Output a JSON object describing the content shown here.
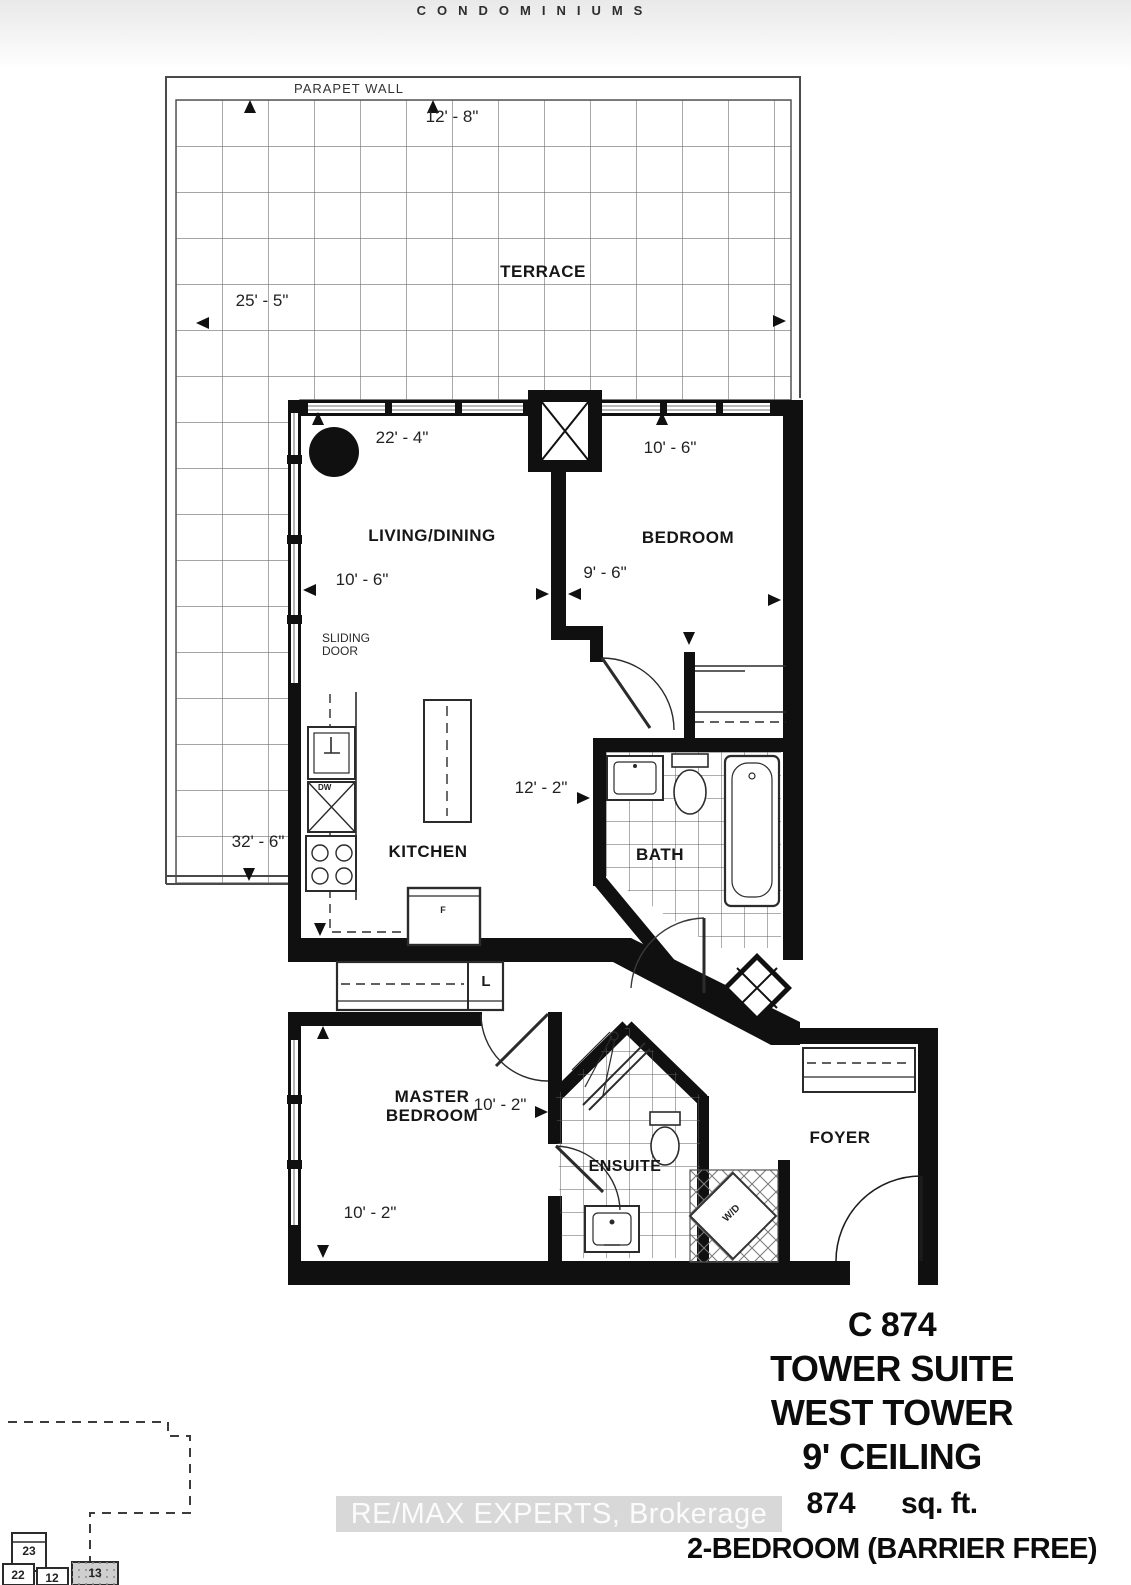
{
  "brand": "CONDOMINIUMS",
  "terrace": {
    "label": "TERRACE",
    "parapet": "PARAPET WALL",
    "dim_top": "12' - 8\"",
    "dim_left": "25' - 5\"",
    "dim_bottom": "32' - 6\""
  },
  "living": {
    "label": "LIVING/DINING",
    "dim_width": "22' - 4\"",
    "dim_depth": "10' - 6\"",
    "sliding_door": "SLIDING\nDOOR"
  },
  "bedroom": {
    "label": "BEDROOM",
    "dim_width": "10' - 6\"",
    "dim_depth": "9' - 6\""
  },
  "kitchen": {
    "label": "KITCHEN",
    "dim_hall": "12' - 2\"",
    "dishwasher": "DW",
    "fridge": "F",
    "linen": "L"
  },
  "bath": {
    "label": "BATH"
  },
  "master_bedroom": {
    "label": "MASTER\nBEDROOM",
    "dim_width": "10' - 2\"",
    "dim_depth": "10' - 2\""
  },
  "ensuite": {
    "label": "ENSUITE",
    "washer_dryer": "W/D"
  },
  "foyer": {
    "label": "FOYER"
  },
  "suite_info": {
    "unit": "C 874",
    "suite": "TOWER SUITE",
    "tower": "WEST TOWER",
    "ceiling": "9' CEILING",
    "area_value": "874",
    "area_unit": "sq. ft.",
    "layout": "2-BEDROOM (BARRIER FREE)"
  },
  "watermark": "RE/MAX EXPERTS, Brokerage",
  "keyplan": {
    "units": [
      "23",
      "22",
      "12",
      "13"
    ]
  }
}
